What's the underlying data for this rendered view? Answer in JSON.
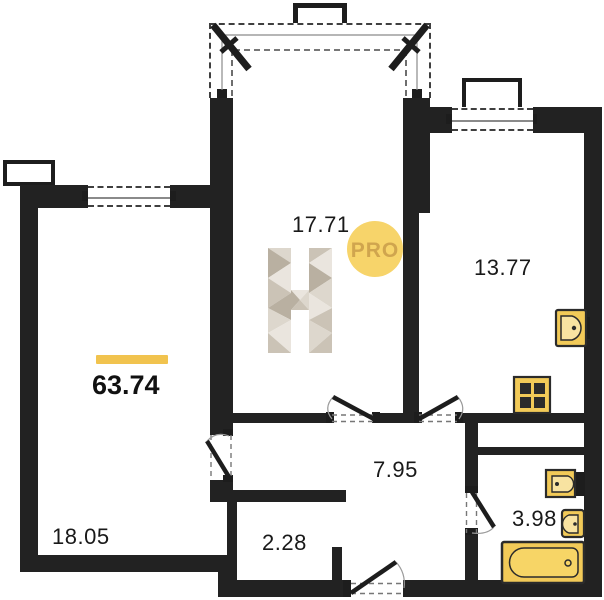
{
  "plan": {
    "title": "apartment-floor-plan",
    "badge": "PRO",
    "watermark": "H",
    "total_area": "63.74",
    "rooms": [
      {
        "name": "bedroom",
        "area": "18.05"
      },
      {
        "name": "living-room",
        "area": "17.71"
      },
      {
        "name": "kitchen",
        "area": "13.77"
      },
      {
        "name": "hallway",
        "area": "7.95"
      },
      {
        "name": "closet",
        "area": "2.28"
      },
      {
        "name": "bathroom",
        "area": "3.98"
      }
    ],
    "fixtures": [
      {
        "name": "kitchen-sink"
      },
      {
        "name": "stove"
      },
      {
        "name": "washbasin"
      },
      {
        "name": "toilet"
      },
      {
        "name": "bathtub"
      }
    ],
    "colors": {
      "wall": "#222222",
      "accent": "#f1c34e",
      "fixture_fill": "#f2ca58",
      "badge_fill": "#f7d46a",
      "badge_text": "#d0a54e"
    }
  }
}
